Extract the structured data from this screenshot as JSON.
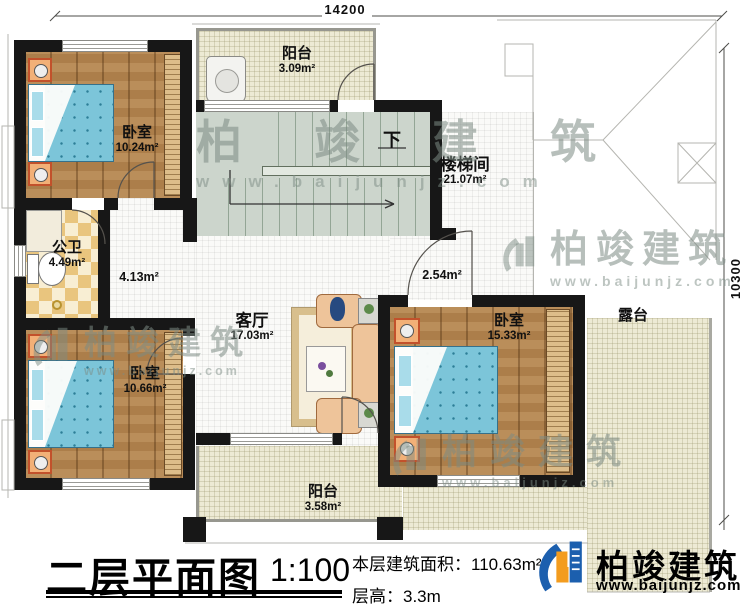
{
  "dimensions": {
    "top_width": "14200",
    "right_height": "10300"
  },
  "rooms": [
    {
      "name": "阳台",
      "area": "3.09m²"
    },
    {
      "name": "卧室",
      "area": "10.24m²"
    },
    {
      "name": "楼梯间",
      "area": "21.07m²"
    },
    {
      "name": "公卫",
      "area": "4.49m²"
    },
    {
      "name": "客厅",
      "area": "17.03m²"
    },
    {
      "name": "卧室",
      "area": "15.33m²"
    },
    {
      "name": "卧室",
      "area": "10.66m²"
    },
    {
      "name": "阳台",
      "area": "3.58m²"
    },
    {
      "name": "露台",
      "area": ""
    }
  ],
  "annotations": {
    "corridor_left": "4.13m²",
    "corridor_right": "2.54m²",
    "stair_direction": "下"
  },
  "title_block": {
    "title": "二层平面图",
    "scale": "1:100",
    "floor_area_label": "本层建筑面积：",
    "floor_area_value": "110.63m²",
    "floor_height_label": "层高：",
    "floor_height_value": "3.3m"
  },
  "brand": {
    "name": "柏竣建筑",
    "website": "www.baijunjz.com"
  },
  "watermark": {
    "name": "柏竣建筑",
    "website": "www.baijunjz.com"
  },
  "colors": {
    "wall": "#171717",
    "wood_floor": "#b5854e",
    "bed_blue": "#7cc5d9",
    "tile_dark": "#e9c57e",
    "tile_light": "#f8eed3",
    "outdoor_floor": "#edead4",
    "stair_floor": "#ccd5cc",
    "brand_blue": "#1c5fae",
    "brand_orange": "#f39c1f",
    "watermark_gray": "#7c8b83"
  }
}
